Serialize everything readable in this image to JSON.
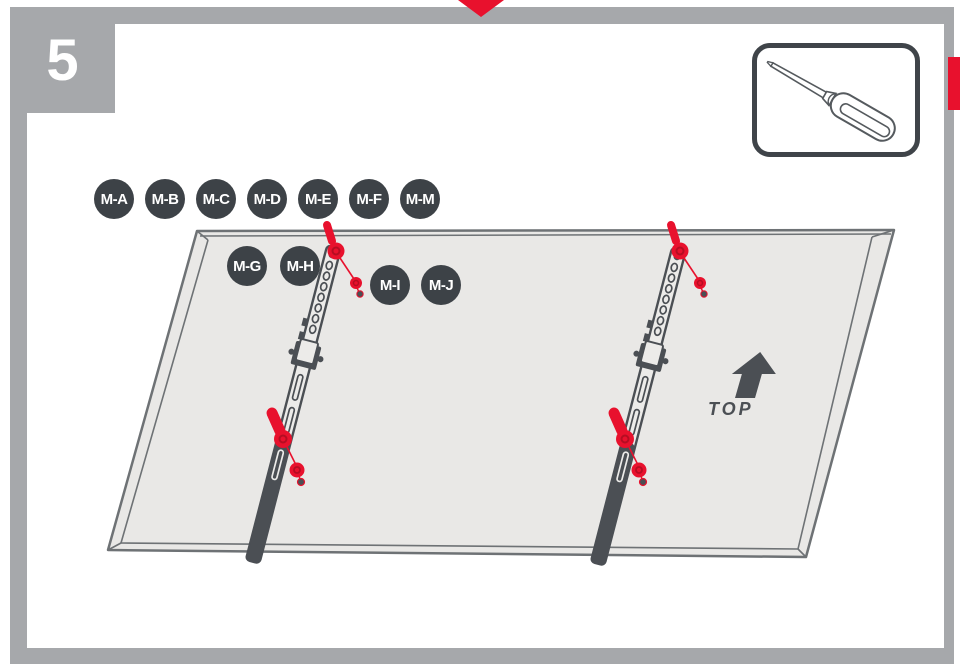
{
  "page": {
    "step": "5"
  },
  "marker": {
    "name": "red-down-arrow"
  },
  "tool_callout": {
    "tool": "flathead-screwdriver"
  },
  "badges": {
    "row1": [
      "M-A",
      "M-B",
      "M-C",
      "M-D",
      "M-E",
      "M-F",
      "M-M"
    ],
    "row2": [
      "M-G",
      "M-H",
      "M-I",
      "M-J"
    ]
  },
  "diagram": {
    "top_label": "TOP",
    "subject": "tv-back-panel-with-two-mounting-brackets",
    "fastener_color": "#e8112d"
  },
  "colors": {
    "accent_red": "#e8112d",
    "frame_gray": "#a6a8ab",
    "badge_dark": "#3d4247",
    "panel_fill": "#e9e8e6",
    "panel_line": "#6e7275",
    "bracket_dark": "#4b4f54"
  }
}
